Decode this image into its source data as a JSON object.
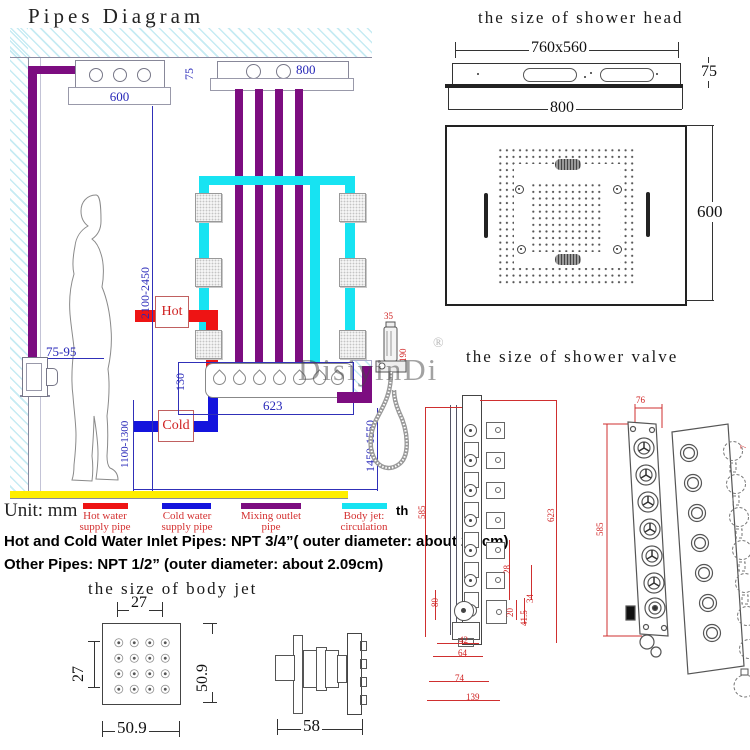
{
  "pipes_diagram": {
    "title": "Pipes Diagram",
    "hot_label": "Hot",
    "cold_label": "Cold",
    "dim_arm_left": "600",
    "dim_arm_gap": "75",
    "dim_arm_right": "800",
    "dim_ceiling_height": "2100-2450",
    "dim_wall_outlet": "75-95",
    "dim_valve_drop": "130",
    "dim_valve_width": "623",
    "dim_cold_height": "1100-1300",
    "dim_handheld_height": "1450-1550",
    "dim_handheld_w": "35",
    "dim_handheld_l": "190"
  },
  "legend": {
    "unit": "Unit: mm",
    "items": [
      {
        "line1": "Hot water",
        "line2": "supply pipe",
        "color": "#ee1414"
      },
      {
        "line1": "Cold water",
        "line2": "supply pipe",
        "color": "#1414dd"
      },
      {
        "line1": "Mixing outlet",
        "line2": "pipe",
        "color": "#7c0d80"
      },
      {
        "line1": "Body jet:",
        "line2": "circulation",
        "color": "#17e3f2"
      }
    ],
    "partial": "th",
    "note1": "Hot and Cold Water Inlet Pipes: NPT 3/4”( outer diameter: about 2.6cm)",
    "note2": "Other Pipes: NPT 1/2” (outer diameter: about 2.09cm)"
  },
  "shower_head": {
    "title": "the size of shower head",
    "dim_panel": "760x560",
    "dim_thickness": "75",
    "dim_width": "800",
    "dim_depth": "600"
  },
  "shower_valve": {
    "title": "the size of shower valve",
    "left": {
      "dim_height": "623",
      "dim_holes": "585",
      "d80": "80",
      "d28": "28",
      "d34": "34",
      "d20": "20",
      "d41_5": "41.5",
      "d42": "42",
      "d64": "64",
      "d74": "74",
      "d139": "139"
    },
    "right": {
      "dim_width": "76",
      "dim_height": "585",
      "d7": "7"
    }
  },
  "body_jet": {
    "title": "the size of body jet",
    "dim_pitch_h": "27",
    "dim_pitch_v": "27",
    "dim_size_v": "50.9",
    "dim_size_h": "50.9",
    "dim_depth": "58"
  },
  "watermark": {
    "text": "DisiyinDi",
    "reg": "®"
  }
}
